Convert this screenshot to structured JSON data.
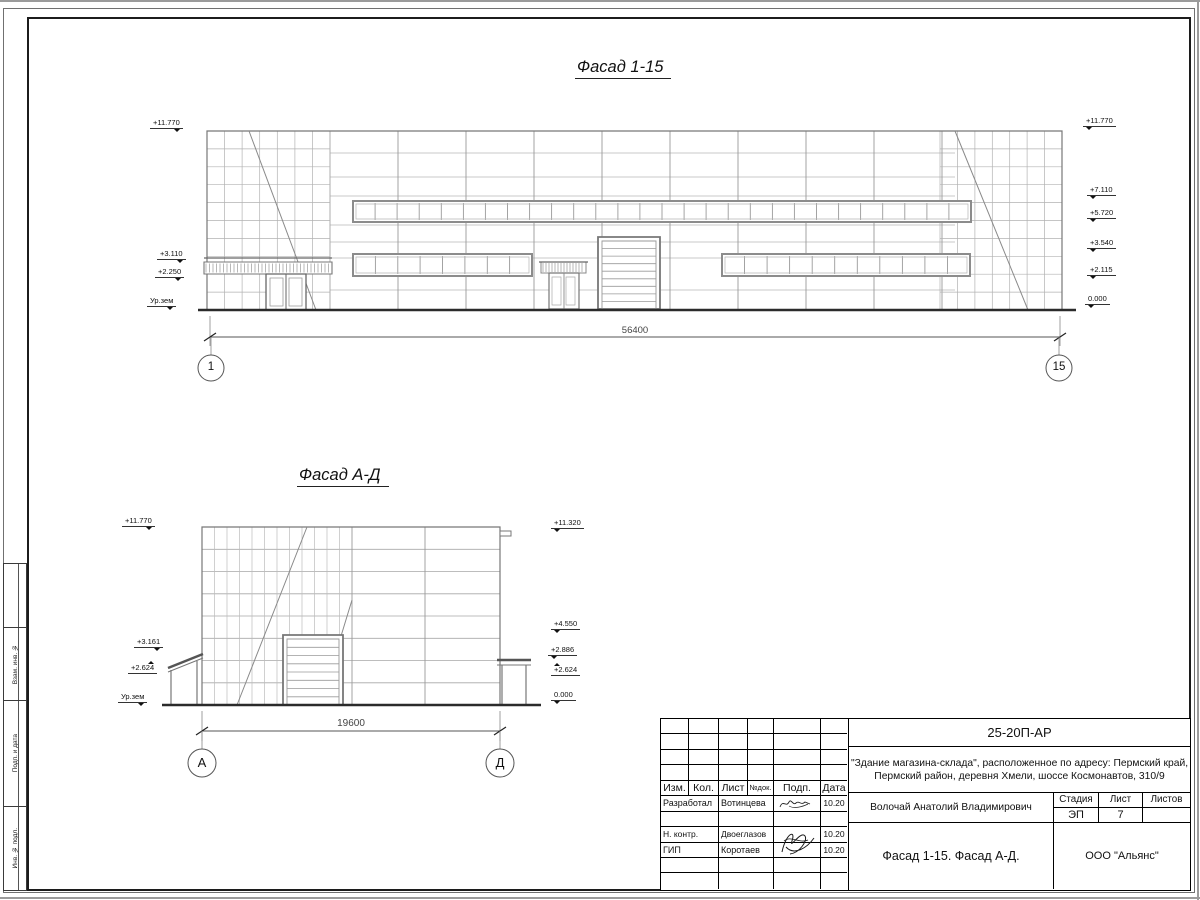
{
  "facade1": {
    "title": "Фасад 1-15",
    "dimension": "56400",
    "axis_left": "1",
    "axis_right": "15",
    "marks_left": [
      "+11.770",
      "+3.110",
      "+2.250",
      "Ур.зем"
    ],
    "marks_right": [
      "+11.770",
      "+7.110",
      "+5.720",
      "+3.540",
      "+2.115",
      "0.000"
    ]
  },
  "facade2": {
    "title": "Фасад А-Д",
    "dimension": "19600",
    "axis_left": "А",
    "axis_right": "Д",
    "marks_left": [
      "+11.770",
      "+3.161",
      "+2.624",
      "Ур.зем"
    ],
    "marks_right": [
      "+11.320",
      "+4.550",
      "+2.886",
      "+2.624",
      "0.000"
    ]
  },
  "side_stamp": [
    "Взам. инв. №",
    "Подп. и дата",
    "Инв. № подл."
  ],
  "title_block": {
    "doc_number": "25-20П-АР",
    "project_line1": "\"Здание магазина-склада\", расположенное по адресу: Пермский край,",
    "project_line2": "Пермский район, деревня Хмели, шоссе Космонавтов, 310/9",
    "header_cols": [
      "Изм.",
      "Кол.",
      "Лист",
      "№док.",
      "Подп.",
      "Дата"
    ],
    "rows": [
      {
        "role": "Разработал",
        "name": "Вотинцева",
        "date": "10.20"
      },
      {
        "role": "Н. контр.",
        "name": "Двоеглазов",
        "date": "10.20"
      },
      {
        "role": "ГИП",
        "name": "Коротаев",
        "date": "10.20"
      }
    ],
    "chief_name": "Волочай Анатолий Владимирович",
    "stage_label": "Стадия",
    "sheet_label": "Лист",
    "sheets_label": "Листов",
    "stage": "ЭП",
    "sheet": "7",
    "sheets": "",
    "sheet_title": "Фасад 1-15. Фасад А-Д.",
    "company": "ООО \"Альянс\""
  }
}
